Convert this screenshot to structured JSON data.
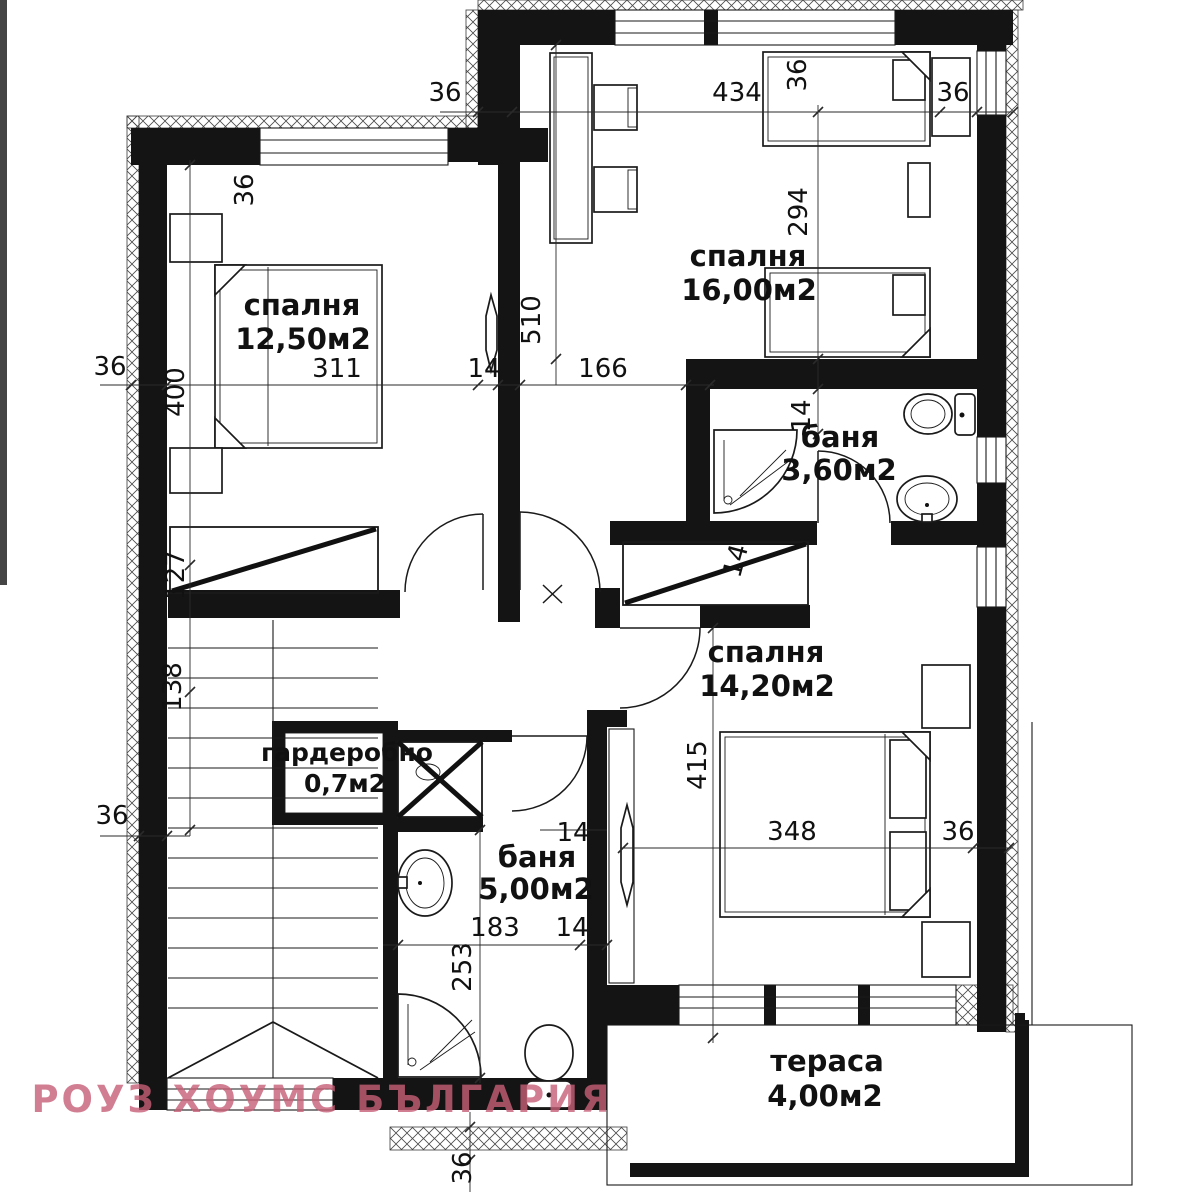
{
  "watermark": {
    "text": "РОУЗ ХОУМС БЪЛГАРИЯ",
    "color": "#c75f77"
  },
  "rooms": {
    "bedroom1": {
      "name": "спалня",
      "area": "12,50м2"
    },
    "bedroom2": {
      "name": "спалня",
      "area": "16,00м2"
    },
    "bath_small": {
      "name": "баня",
      "area": "3,60м2"
    },
    "bedroom3": {
      "name": "спалня",
      "area": "14,20м2"
    },
    "closet": {
      "name": "гардеробно",
      "area": "0,7м2"
    },
    "bath_big": {
      "name": "баня",
      "area": "5,00м2"
    },
    "terrace": {
      "name": "тераса",
      "area": "4,00м2"
    }
  },
  "dims": {
    "d_step_top": "36",
    "d_top_width": "434",
    "d_top_right": "36",
    "d_b1_topwall": "36",
    "d_b2_side": "36",
    "d_b2_width": "294",
    "d_b1_height": "400",
    "d_b1_width": "311",
    "d_wall_14": "14",
    "d_hall_166": "166",
    "d_b2_depth": "510",
    "d_left_36a": "36",
    "d_bath_s_14": "14",
    "d_niche_14": "14",
    "d_stair_127": "127",
    "d_stair_138": "138",
    "d_left_36b": "36",
    "d_bath_b_14a": "14",
    "d_bath_b_183": "183",
    "d_bath_b_14b": "14",
    "d_bath_b_253": "253",
    "d_b3_height": "415",
    "d_b3_width": "348",
    "d_b3_right": "36",
    "d_bottom_36": "36"
  }
}
